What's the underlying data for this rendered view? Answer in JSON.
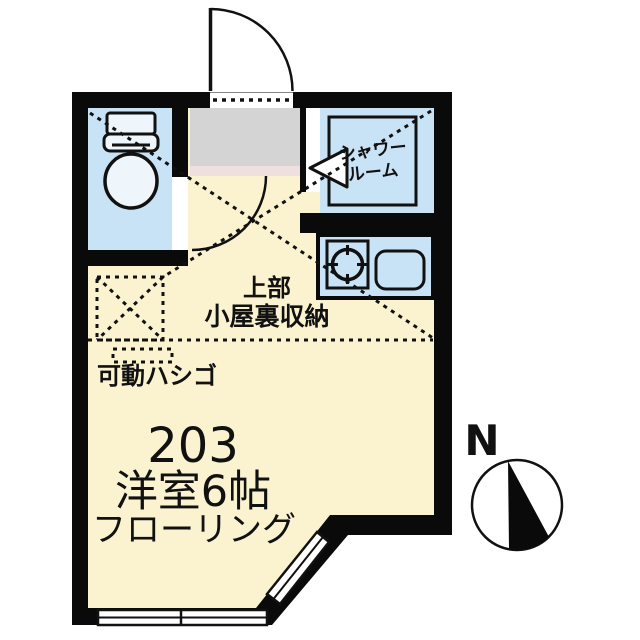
{
  "labels": {
    "shower_line1": "シャワー",
    "shower_line2": "ルーム",
    "loft_line1": "上部",
    "loft_line2": "小屋裏収納",
    "ladder": "可動ハシゴ",
    "unit_number": "203",
    "room_type": "洋室6帖",
    "flooring": "フローリング",
    "north": "N"
  },
  "colors": {
    "wall": "#0a0a0a",
    "floor": "#fbf3d0",
    "water": "#c8e3f5",
    "fixture": "#eef6fc",
    "entrance": "#d4d4d4",
    "step": "#f0dfdf",
    "white": "#ffffff",
    "line": "#111111"
  }
}
